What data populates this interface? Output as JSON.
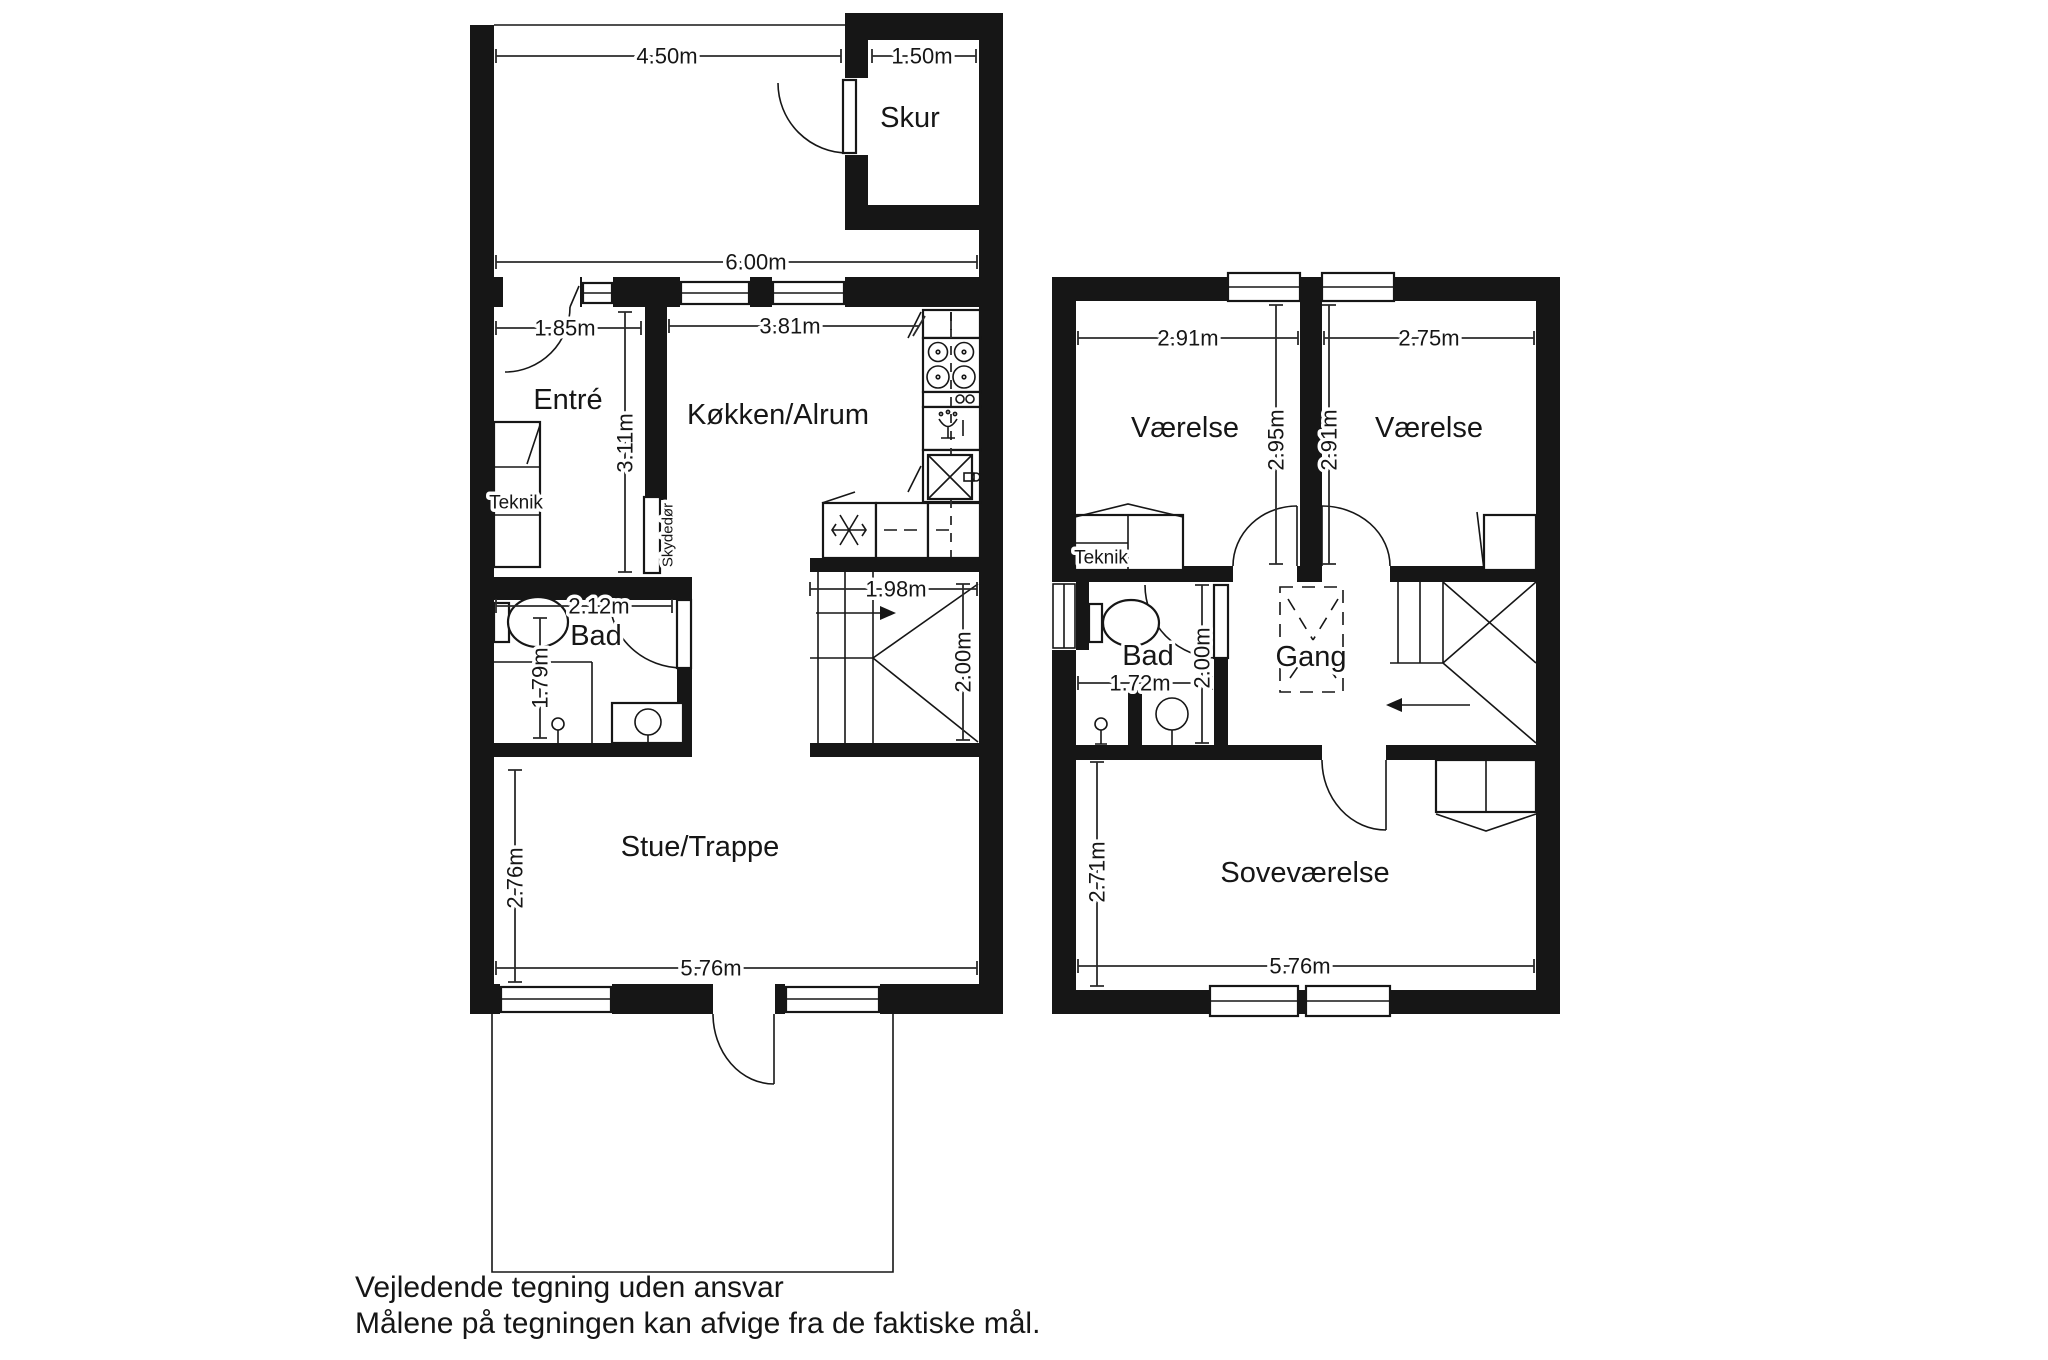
{
  "colors": {
    "ink": "#161616",
    "background": "#ffffff"
  },
  "ground_floor": {
    "garden": {
      "width": "4.50m"
    },
    "skur": {
      "label": "Skur",
      "width": "1.50m"
    },
    "house_width": "6.00m",
    "entre": {
      "label": "Entré",
      "width": "1.85m",
      "depth": "3.11m"
    },
    "teknik": {
      "label": "Teknik"
    },
    "kokken_alrum": {
      "label": "Køkken/Alrum",
      "width": "3.81m"
    },
    "skydedor": {
      "label": "Skydedør"
    },
    "bad": {
      "label": "Bad",
      "width": "2.12m",
      "depth": "1.79m"
    },
    "trappe": {
      "width": "1.98m",
      "depth": "2.00m"
    },
    "stue": {
      "label": "Stue/Trappe",
      "depth": "2.76m",
      "width": "5.76m"
    }
  },
  "first_floor": {
    "vaerelse_left": {
      "label": "Værelse",
      "width": "2.91m",
      "depth": "2.95m"
    },
    "vaerelse_right": {
      "label": "Værelse",
      "width": "2.75m",
      "depth": "2.91m"
    },
    "teknik": {
      "label": "Teknik"
    },
    "bad": {
      "label": "Bad",
      "width": "1.72m",
      "depth": "2.00m"
    },
    "gang": {
      "label": "Gang"
    },
    "sovevaerelse": {
      "label": "Soveværelse",
      "depth": "2.71m",
      "width": "5.76m"
    }
  },
  "footer": {
    "line1": "Vejledende tegning uden ansvar",
    "line2": "Målene på tegningen kan afvige fra de faktiske mål."
  }
}
